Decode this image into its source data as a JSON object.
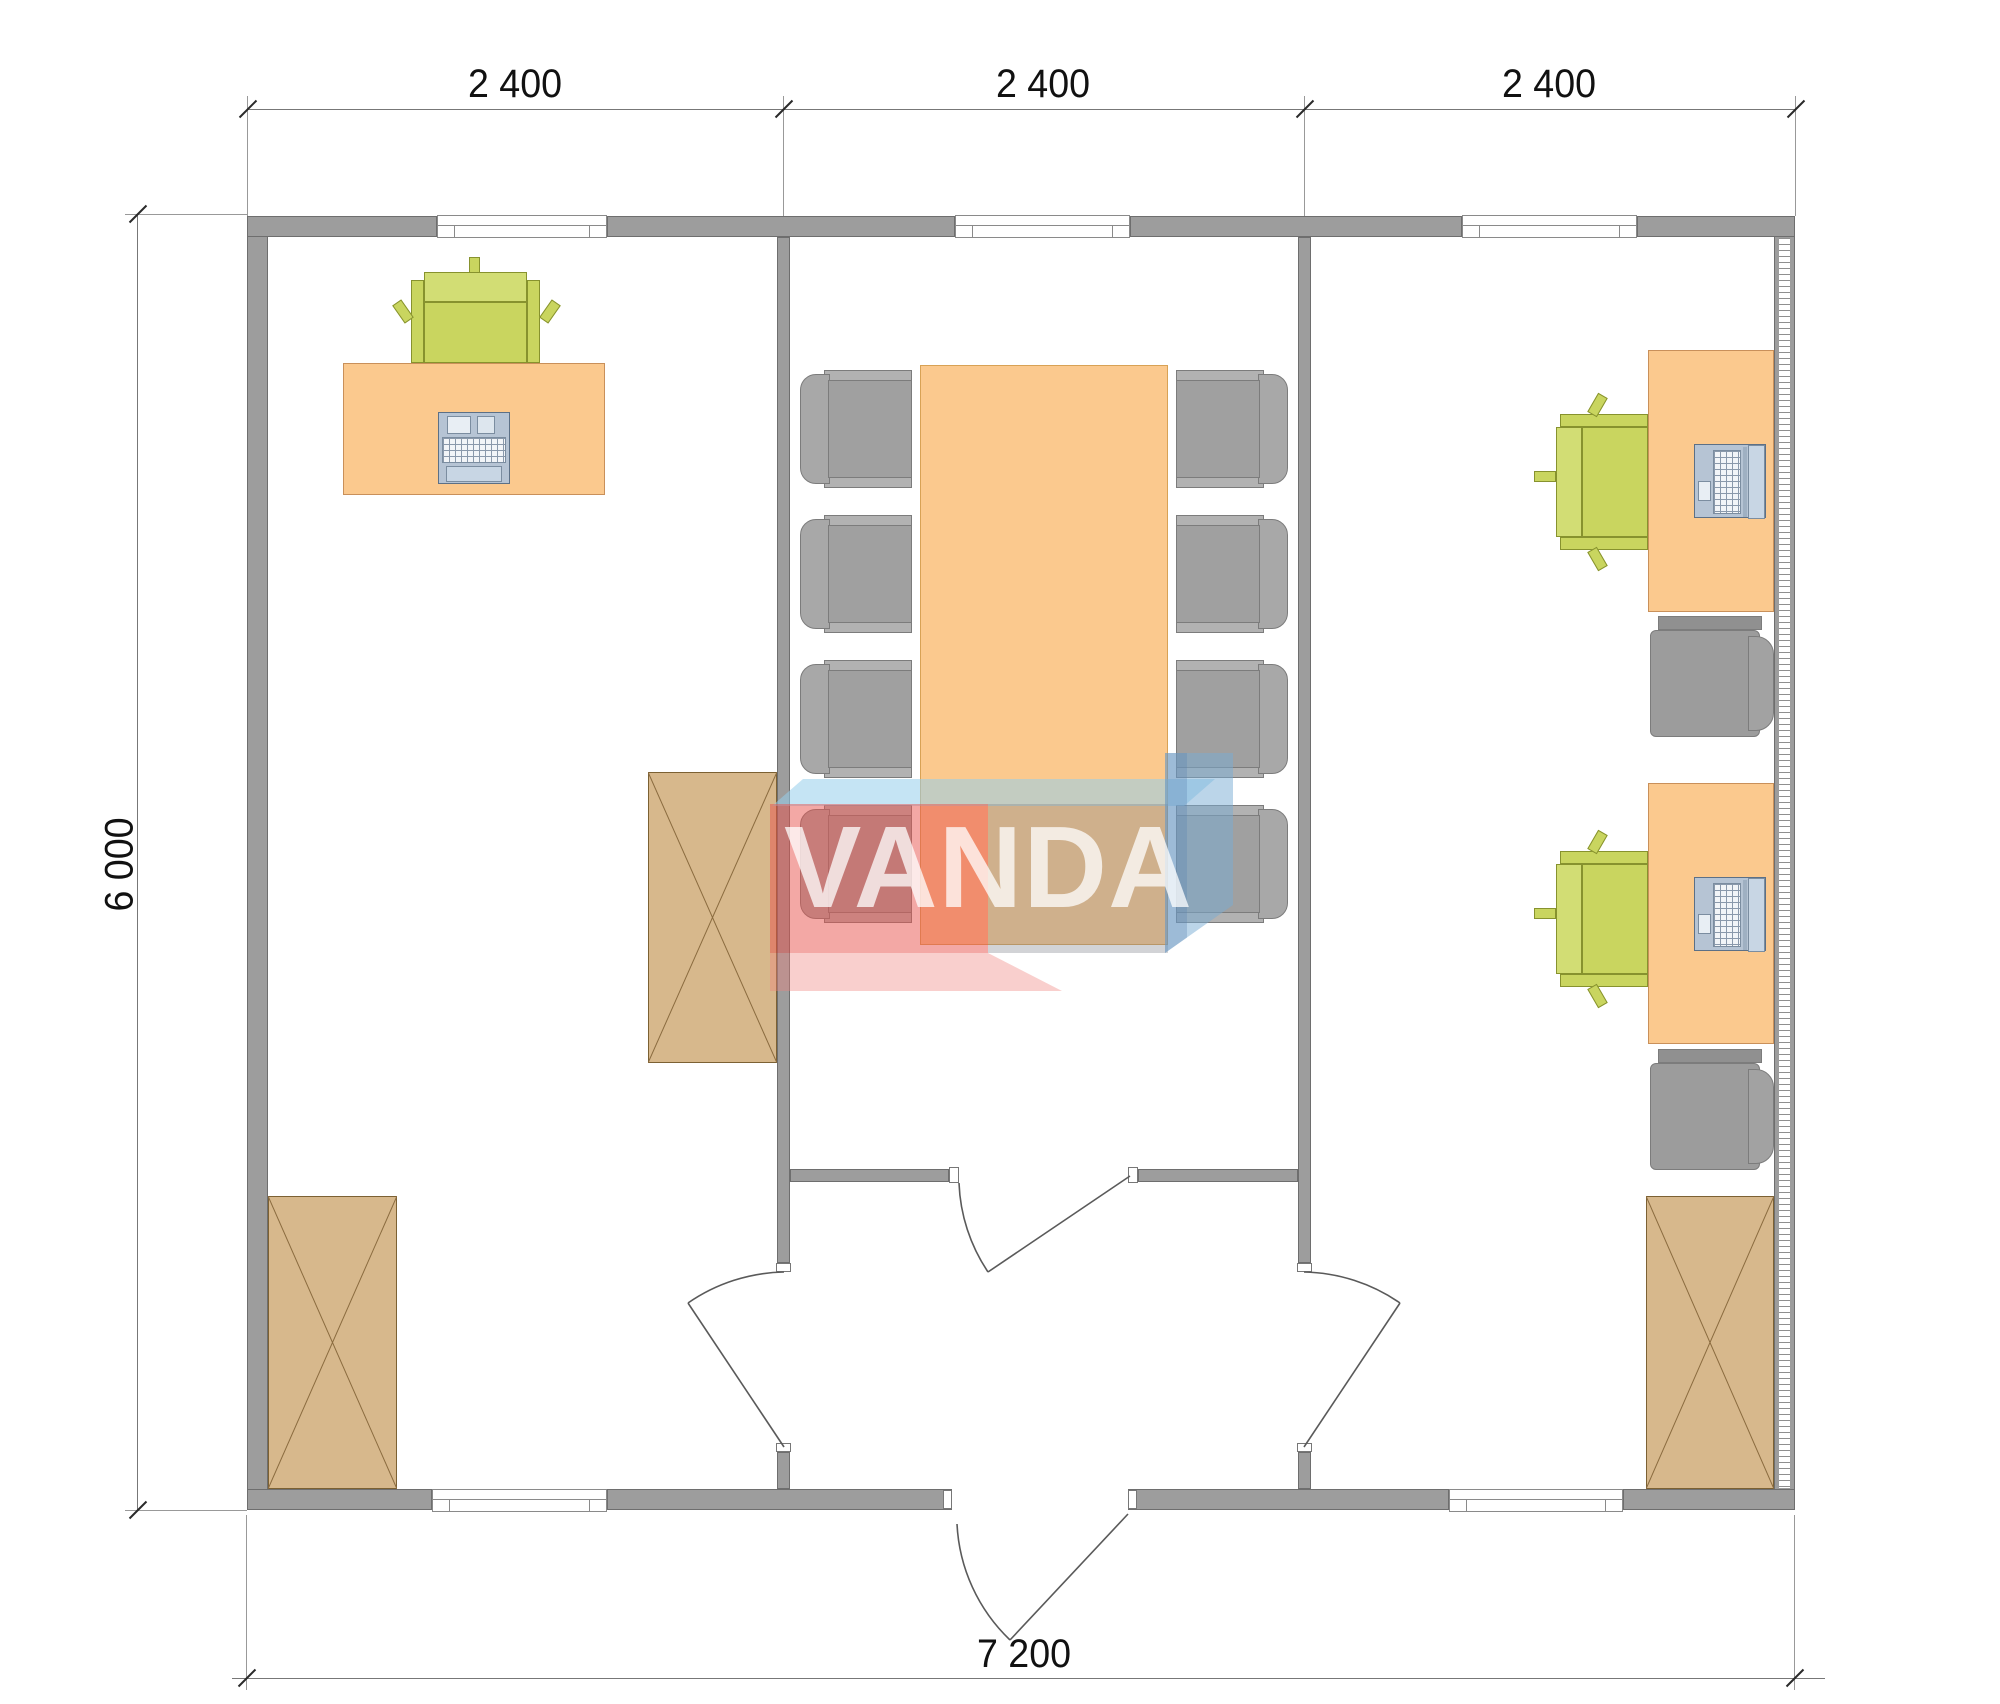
{
  "drawing": {
    "type": "architectural-floor-plan",
    "watermark": {
      "text": "VANDA",
      "colors": {
        "red": "#e8524b",
        "light_blue": "#96cbe7",
        "steel_blue": "#7aa6d2",
        "pink": "#ee827c"
      }
    },
    "dimensions": {
      "top_segments": [
        "2 400",
        "2 400",
        "2 400"
      ],
      "left_total": "6 000",
      "bottom_total": "7 200"
    },
    "plan": {
      "rooms": [
        {
          "id": "left-office",
          "furniture": [
            "desk",
            "task-chair-green",
            "keyboard-workstation",
            "cabinet-x",
            "cabinet-x"
          ]
        },
        {
          "id": "meeting-room",
          "furniture": [
            "conference-table",
            "meeting-chair-gray x8"
          ]
        },
        {
          "id": "right-office",
          "furniture": [
            "desk x2",
            "task-chair-green x2",
            "laptop x2",
            "side-chair-gray x2",
            "cabinet-x"
          ]
        }
      ],
      "windows_count": 5,
      "doors_count": 4
    },
    "palette": {
      "wall": "#9d9d9d",
      "desk_orange": "#fbc98e",
      "chair_green": "#c9d55f",
      "chair_gray": "#a6a6a6",
      "cabinet_tan": "#d7b88c",
      "device_blue": "#c3d2e2",
      "line": "#6e6e6e"
    }
  }
}
